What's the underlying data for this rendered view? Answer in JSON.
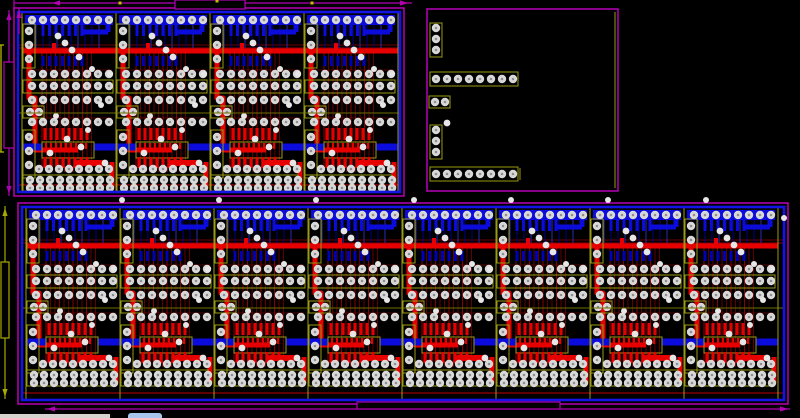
{
  "app": {
    "name": "pcb-layout-editor-viewport",
    "description": "PCB panelized board layout view with two module arrays, one connector breakout board and dimension annotations",
    "visible_text": ""
  },
  "canvas": {
    "width": 800,
    "height": 418
  },
  "colors": {
    "background": "#000000",
    "panel_border_magenta": "#c400c4",
    "board_outline_blue": "#1414e6",
    "trace_blue": "#0b0bdc",
    "trace_blue_dim": "#0000b4",
    "trace_blue_thin": "#00008c",
    "trace_red": "#e60000",
    "trace_red_thin": "#6e0000",
    "trace_red_mid": "#9a0000",
    "silk_olive": "#9a9a14",
    "silk_olive_dim": "#6e6e00",
    "pad_fill": "#d8d8d8",
    "pad_hole": "#8e8e8e",
    "via_fill": "#e6e6e6",
    "dim_magenta": "#b400b4",
    "dim_olive": "#a8a800",
    "dim_yellow": "#c0c000",
    "taskbar_gray": "#d6d3ce",
    "taskbar_blue": "#a9c7ec"
  },
  "panels": [
    {
      "id": "top-left-module-array",
      "outer": [
        14,
        8,
        390,
        188
      ],
      "inner": [
        18,
        12,
        382,
        180
      ],
      "module_count": 4,
      "module_start_x": 22,
      "module_width": 94,
      "module_top": 12,
      "module_height": 180
    },
    {
      "id": "bottom-module-array",
      "outer": [
        18,
        203,
        770,
        201
      ],
      "inner": [
        22,
        207,
        762,
        193
      ],
      "module_count": 8,
      "module_start_x": 26,
      "module_width": 94,
      "module_top": 207,
      "module_height": 180
    }
  ],
  "connector_panel": {
    "id": "top-right-breakout-board",
    "outer": [
      427,
      9,
      191,
      182
    ],
    "right_silk_line": [
      615,
      12,
      615,
      188
    ],
    "components": [
      {
        "type": "header-3-vertical",
        "box": [
          430,
          23,
          12,
          34
        ],
        "pad_x": 436,
        "pad_ys": [
          28,
          39,
          50
        ]
      },
      {
        "type": "header-8-horizontal",
        "box": [
          430,
          72,
          88,
          14
        ],
        "pad_y": 79,
        "pad_start_x": 436,
        "pad_pitch": 11,
        "pad_count": 8
      },
      {
        "type": "pad-pair-horizontal",
        "box": [
          429,
          96,
          21,
          12
        ],
        "pad_y": 102,
        "pad_xs": [
          435,
          445
        ]
      },
      {
        "type": "via",
        "x": 447,
        "y": 123
      },
      {
        "type": "header-3-vertical",
        "box": [
          430,
          125,
          12,
          34
        ],
        "pad_x": 436,
        "pad_ys": [
          130,
          141,
          152
        ]
      },
      {
        "type": "header-8-horizontal",
        "box": [
          430,
          167,
          88,
          14
        ],
        "pad_y": 174,
        "pad_start_x": 436,
        "pad_pitch": 11,
        "pad_count": 8,
        "end_tick_x": 520
      }
    ]
  },
  "dimensions": [
    {
      "id": "top-width-dimension",
      "color_key": "dim_magenta",
      "lines": [
        [
          14,
          3,
          412,
          3
        ],
        [
          14,
          0,
          14,
          10
        ]
      ],
      "arrows": [
        [
          52,
          3,
          "left"
        ],
        [
          408,
          3,
          "right"
        ]
      ],
      "box": [
        175,
        0,
        70,
        9
      ],
      "ticks": [
        [
          120,
          3
        ],
        [
          217,
          1
        ],
        [
          312,
          3
        ]
      ]
    },
    {
      "id": "top-left-height-dimension",
      "color_key": "dim_magenta",
      "lines": [
        [
          9,
          10,
          9,
          196
        ]
      ],
      "arrows": [
        [
          9,
          12,
          "up"
        ],
        [
          9,
          194,
          "down"
        ]
      ],
      "box": [
        4,
        62,
        10,
        86
      ],
      "ticks": []
    },
    {
      "id": "top-left-edge-extension",
      "color_key": "dim_yellow",
      "lines": [
        [
          1,
          45,
          1,
          152
        ],
        [
          0,
          45,
          4,
          45
        ],
        [
          0,
          152,
          4,
          152
        ]
      ],
      "arrows": [],
      "box": null,
      "ticks": []
    },
    {
      "id": "top-small-vertical-pointer",
      "color_key": "dim_magenta",
      "lines": [
        [
          19,
          8,
          19,
          34
        ]
      ],
      "arrows": [
        [
          19,
          10,
          "up"
        ]
      ],
      "box": null,
      "ticks": []
    },
    {
      "id": "bottom-left-height-dimension",
      "color_key": "dim_olive",
      "lines": [
        [
          5,
          206,
          5,
          399
        ]
      ],
      "arrows": [
        [
          5,
          208,
          "up"
        ],
        [
          5,
          397,
          "down"
        ]
      ],
      "box": [
        1,
        262,
        8,
        76
      ],
      "ticks": []
    },
    {
      "id": "bottom-width-dimension",
      "color_key": "dim_magenta",
      "lines": [
        [
          45,
          409,
          790,
          409
        ]
      ],
      "arrows": [
        [
          47,
          409,
          "left"
        ],
        [
          788,
          409,
          "right"
        ]
      ],
      "box": [
        357,
        402,
        203,
        7
      ],
      "ticks": []
    }
  ],
  "stray_vias": [
    [
      122,
      200
    ],
    [
      219,
      200
    ],
    [
      316,
      200
    ],
    [
      414,
      200
    ],
    [
      511,
      200
    ],
    [
      608,
      200
    ],
    [
      706,
      200
    ],
    [
      784,
      218
    ]
  ],
  "os_strip": {
    "gray": [
      0,
      414,
      110,
      4
    ],
    "blue": [
      128,
      413,
      34,
      5
    ]
  }
}
